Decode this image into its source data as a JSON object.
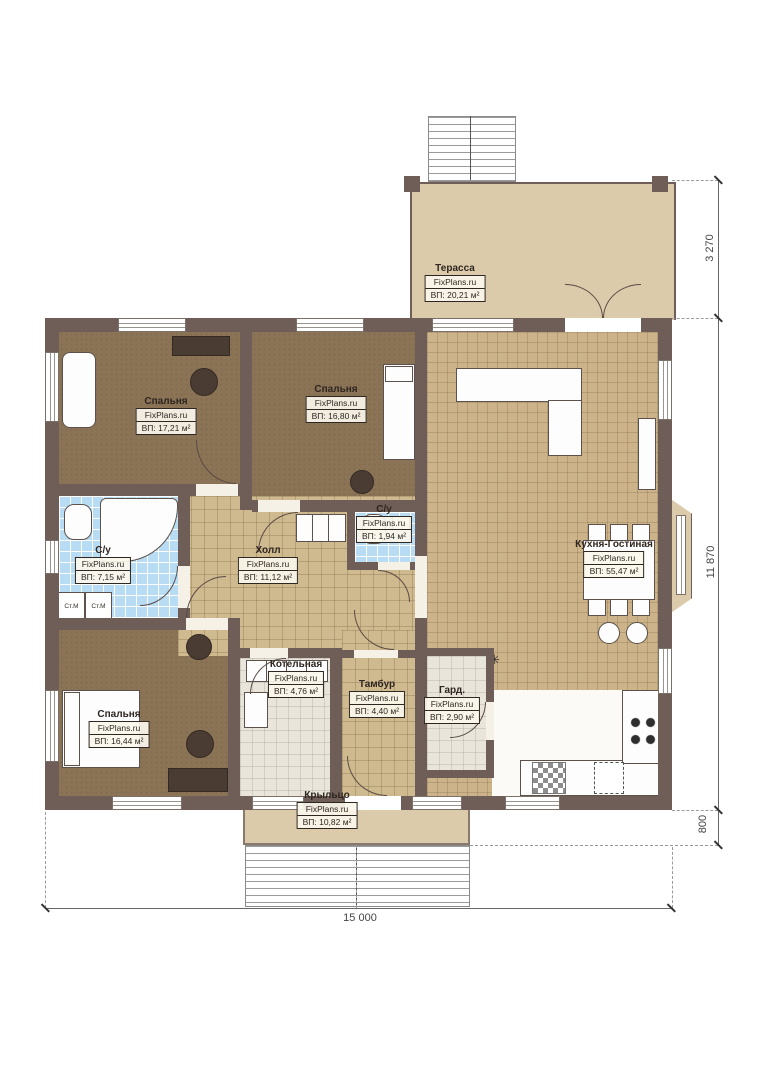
{
  "brand": "FixPlans.ru",
  "rooms": {
    "terrace": {
      "name": "Терасса",
      "area": "ВП: 20,21 м²"
    },
    "bedroom1": {
      "name": "Спальня",
      "area": "ВП: 17,21 м²"
    },
    "bedroom2": {
      "name": "Спальня",
      "area": "ВП: 16,80 м²"
    },
    "wc_small": {
      "name": "С/у",
      "area": "ВП: 1,94 м²"
    },
    "hall": {
      "name": "Холл",
      "area": "ВП: 11,12 м²"
    },
    "bathroom": {
      "name": "С/у",
      "area": "ВП: 7,15 м²"
    },
    "kitchen": {
      "name": "Кухня-Гостиная",
      "area": "ВП: 55,47 м²"
    },
    "boiler": {
      "name": "Котельная",
      "area": "ВП: 4,76 м²"
    },
    "tambour": {
      "name": "Тамбур",
      "area": "ВП: 4,40 м²"
    },
    "wardrobe": {
      "name": "Гард.",
      "area": "ВП: 2,90 м²"
    },
    "bedroom3": {
      "name": "Спальня",
      "area": "ВП: 16,44 м²"
    },
    "porch": {
      "name": "Крыльцо",
      "area": "ВП: 10,82 м²"
    }
  },
  "dimensions": {
    "terrace_depth": "3 270",
    "house_depth": "11 870",
    "porch_depth": "800",
    "house_width": "15 000"
  },
  "fixtures": {
    "washer": "Ст.М",
    "star": "✳"
  },
  "colors": {
    "wall": "#6f5d58",
    "wood_floor": "#8b7355",
    "tile_floor": "#cfb98e",
    "bath_tile": "#b9dcf5",
    "terrace_floor": "#dccbaa"
  }
}
